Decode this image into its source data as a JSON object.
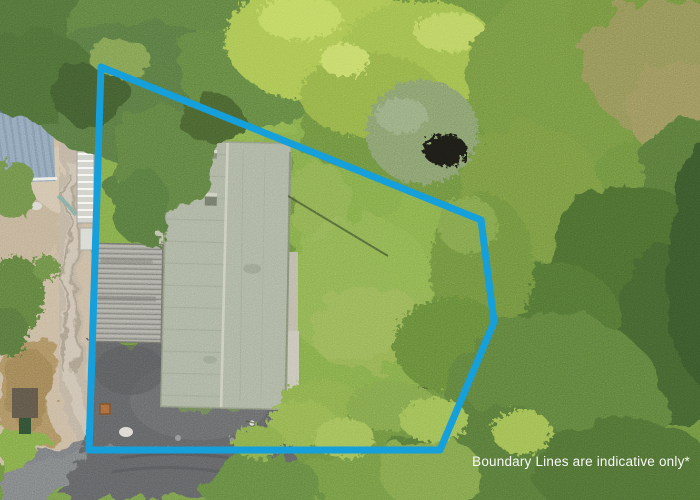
{
  "caption": {
    "text": "Boundary Lines are indicative only*",
    "color": "#ffffff"
  },
  "boundary": {
    "color": "#159fdb",
    "stroke_width": 7,
    "points": [
      [
        101,
        67
      ],
      [
        481,
        220
      ],
      [
        494,
        322
      ],
      [
        440,
        450
      ],
      [
        89,
        450
      ]
    ]
  },
  "colors": {
    "base_green": "#6b8d3e",
    "lawn": "#7fa747",
    "lawn_light": "#92b456",
    "tree_dark": "#4f6e38",
    "tree_mid": "#5d7d40",
    "tree_light": "#71913f",
    "lime": "#a7c24f",
    "lime_light": "#bdd45f",
    "olive": "#8f8e55",
    "forest_dark": "#42602e",
    "forest_deep": "#395429",
    "bottom_trees": "#5b7b3b",
    "gray_green": "#839a6b",
    "dirt": "#c7b69d",
    "dirt_brown": "#a98c5f",
    "gravel": "#bcb09d",
    "gravel_light": "#cabfae",
    "asphalt": "#5e6062",
    "asphalt_light": "#6e7071",
    "road": "#76797b",
    "roof_sage": "#a9b09d",
    "roof_ridge": "#c7cbb9",
    "roof_seam": "#8d9680",
    "carport": "#9f9f97",
    "carport_dark": "#7e7e77",
    "shed_blue": "#8da3b6",
    "shed_blue_dark": "#7d94a9",
    "concrete": "#c5c2b3",
    "white_obj": "#f0f0ea",
    "marker": "#a5673b",
    "fence": "#45552f"
  }
}
